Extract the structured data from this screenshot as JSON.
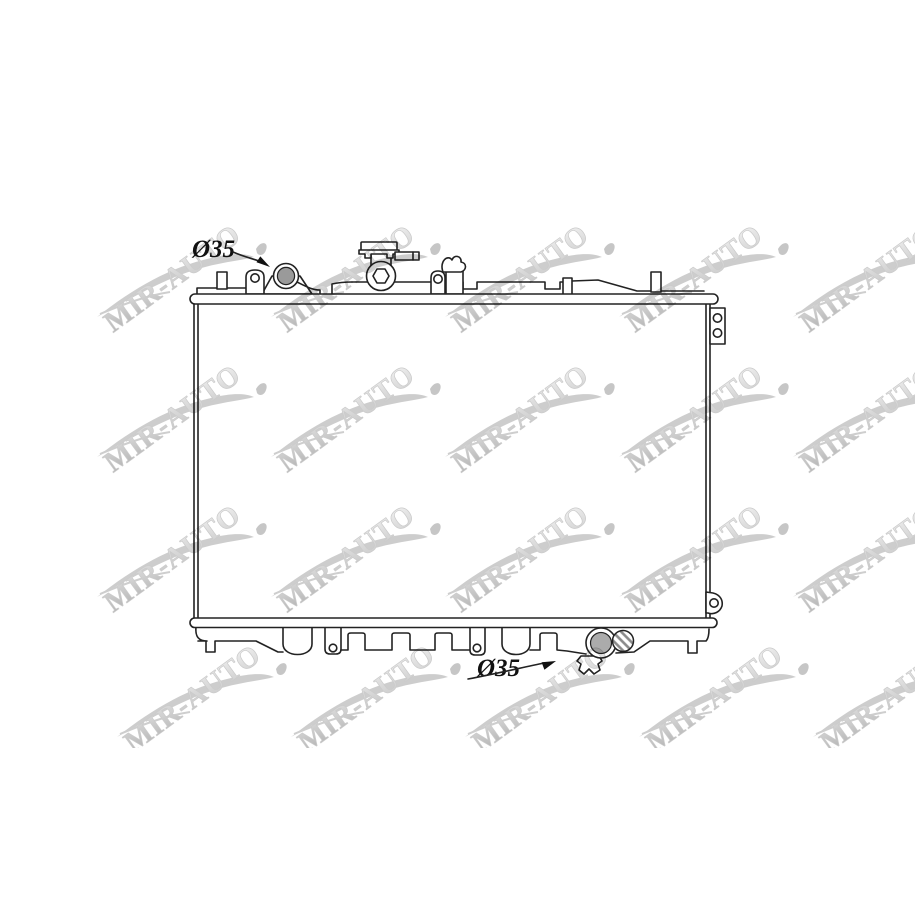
{
  "watermark": {
    "text": "MIR-AUTO",
    "color": "#c0c0c0"
  },
  "annotations": {
    "inlet_diameter_label": "Ø35",
    "outlet_diameter_label": "Ø35"
  },
  "drawing": {
    "line_color": "#222222",
    "inlet_pipe_fill": "#9a9a9a",
    "outlet_pipe_fill": "#ababab",
    "background": "#ffffff"
  }
}
